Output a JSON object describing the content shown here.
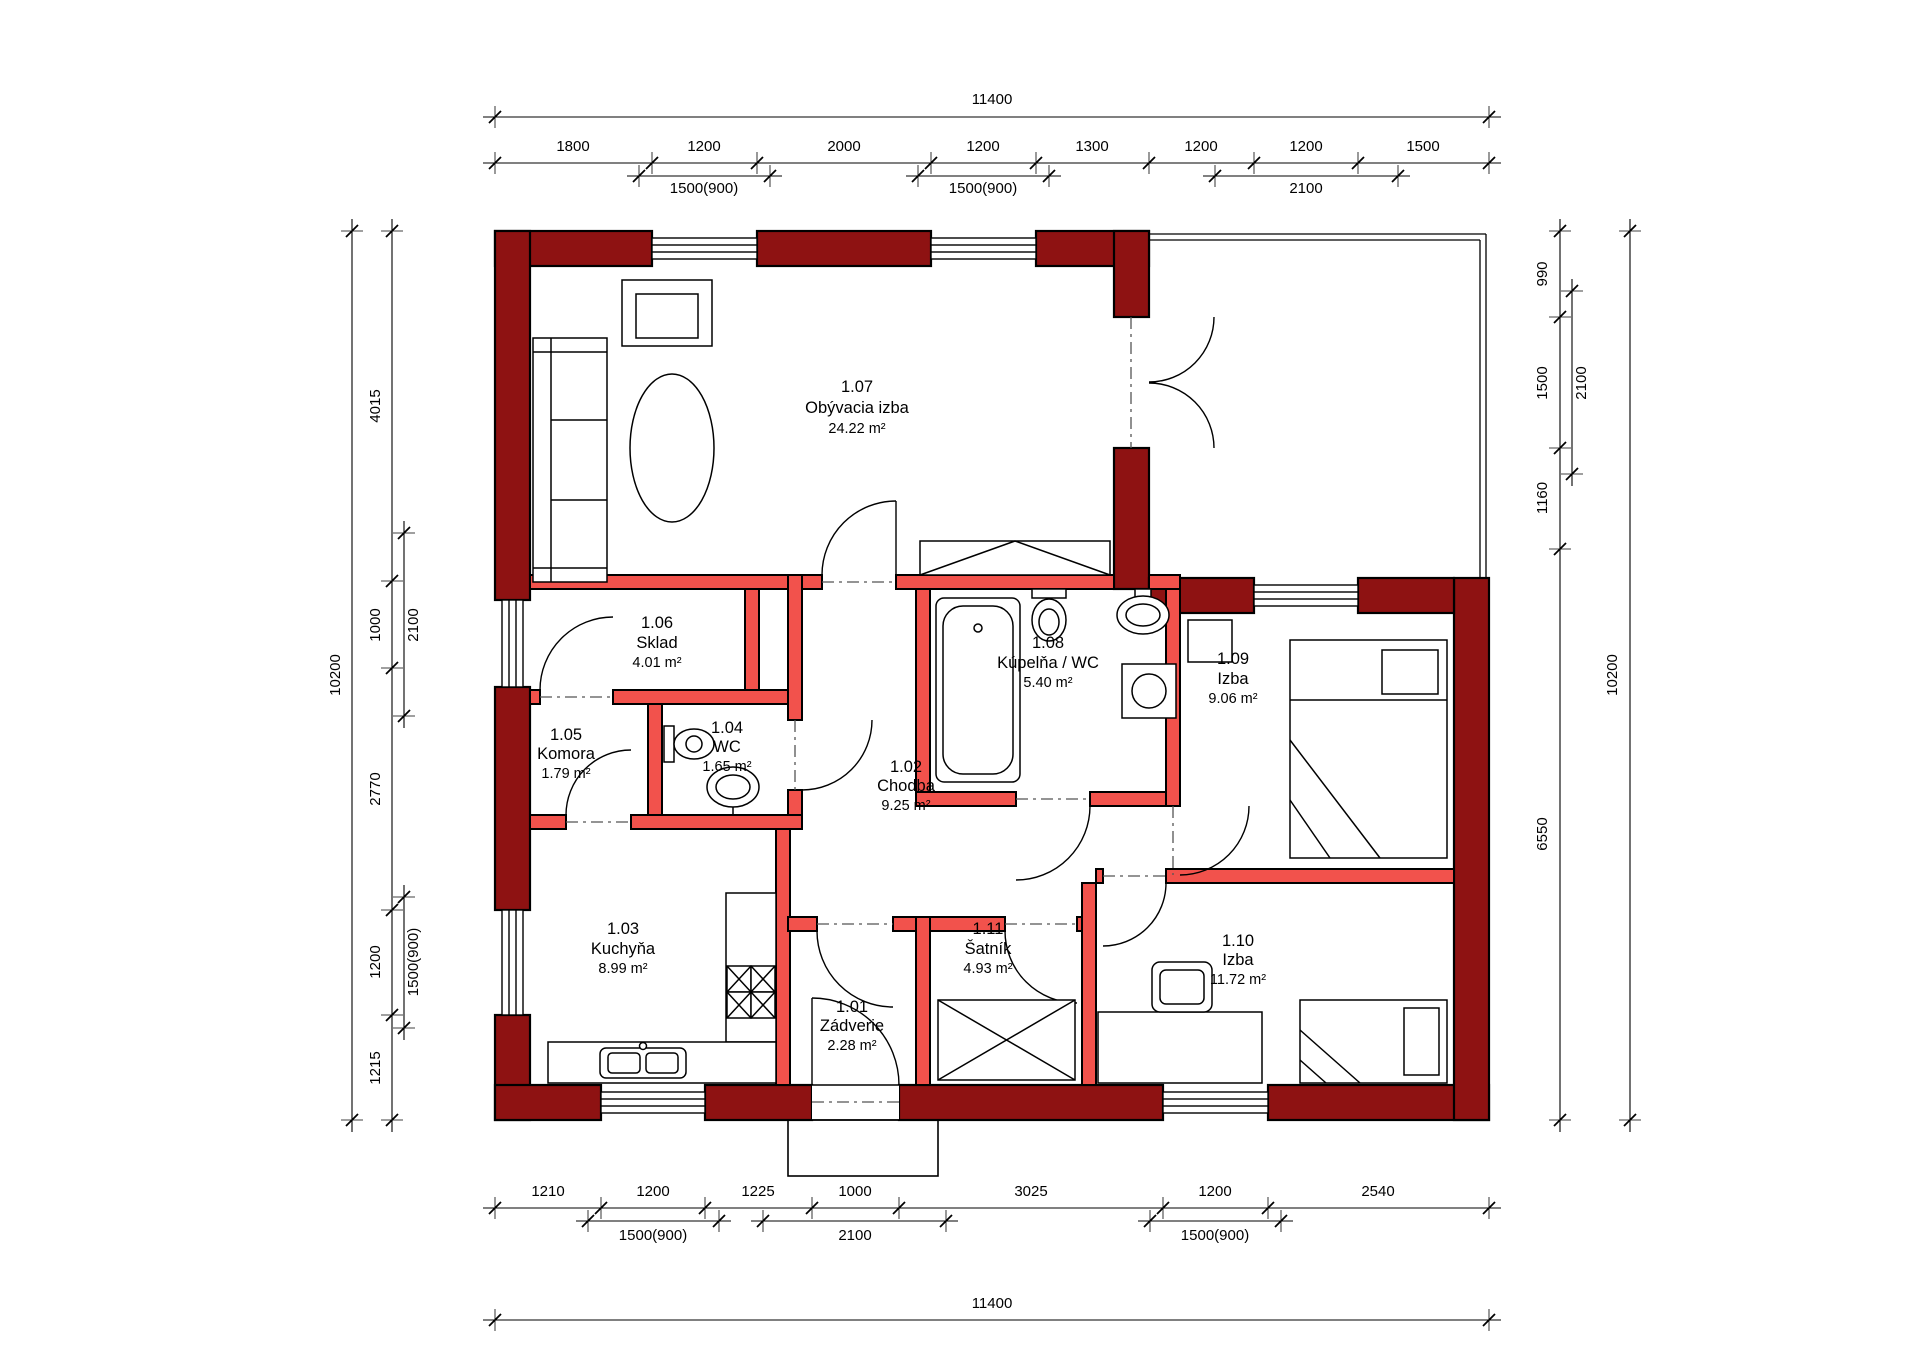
{
  "colors": {
    "exterior_wall": "#8e1212",
    "interior_wall": "#f2524c",
    "line": "#000000",
    "background": "#ffffff"
  },
  "rooms": [
    {
      "number": "1.01",
      "name": "Zádverie",
      "area": "2.28 m²"
    },
    {
      "number": "1.02",
      "name": "Chodba",
      "area": "9.25 m²"
    },
    {
      "number": "1.03",
      "name": "Kuchyňa",
      "area": "8.99 m²"
    },
    {
      "number": "1.04",
      "name": "WC",
      "area": "1.65 m²"
    },
    {
      "number": "1.05",
      "name": "Komora",
      "area": "1.79 m²"
    },
    {
      "number": "1.06",
      "name": "Sklad",
      "area": "4.01 m²"
    },
    {
      "number": "1.07",
      "name": "Obývacia izba",
      "area": "24.22 m²"
    },
    {
      "number": "1.08",
      "name": "Kúpelňa / WC",
      "area": "5.40 m²"
    },
    {
      "number": "1.09",
      "name": "Izba",
      "area": "9.06 m²"
    },
    {
      "number": "1.10",
      "name": "Izba",
      "area": "11.72 m²"
    },
    {
      "number": "1.11",
      "name": "Šatník",
      "area": "4.93 m²"
    }
  ],
  "dimensions": {
    "top": {
      "overall": "11400",
      "segments": [
        "1800",
        "1200",
        "2000",
        "1200",
        "1300",
        "1200",
        "1200",
        "1500"
      ],
      "subs": [
        "1500(900)",
        "1500(900)",
        "2100"
      ]
    },
    "bottom": {
      "overall": "11400",
      "segments": [
        "1210",
        "1200",
        "1225",
        "1000",
        "3025",
        "1200",
        "2540"
      ],
      "subs": [
        "1500(900)",
        "2100",
        "1500(900)"
      ]
    },
    "left": {
      "overall": "10200",
      "segments": [
        "4015",
        "1000",
        "2770",
        "1200",
        "1215"
      ],
      "subs": [
        "2100",
        "1500(900)"
      ]
    },
    "right": {
      "overall": "10200",
      "segments": [
        "990",
        "1500",
        "1160",
        "6550"
      ],
      "subs": [
        "2100"
      ]
    }
  }
}
